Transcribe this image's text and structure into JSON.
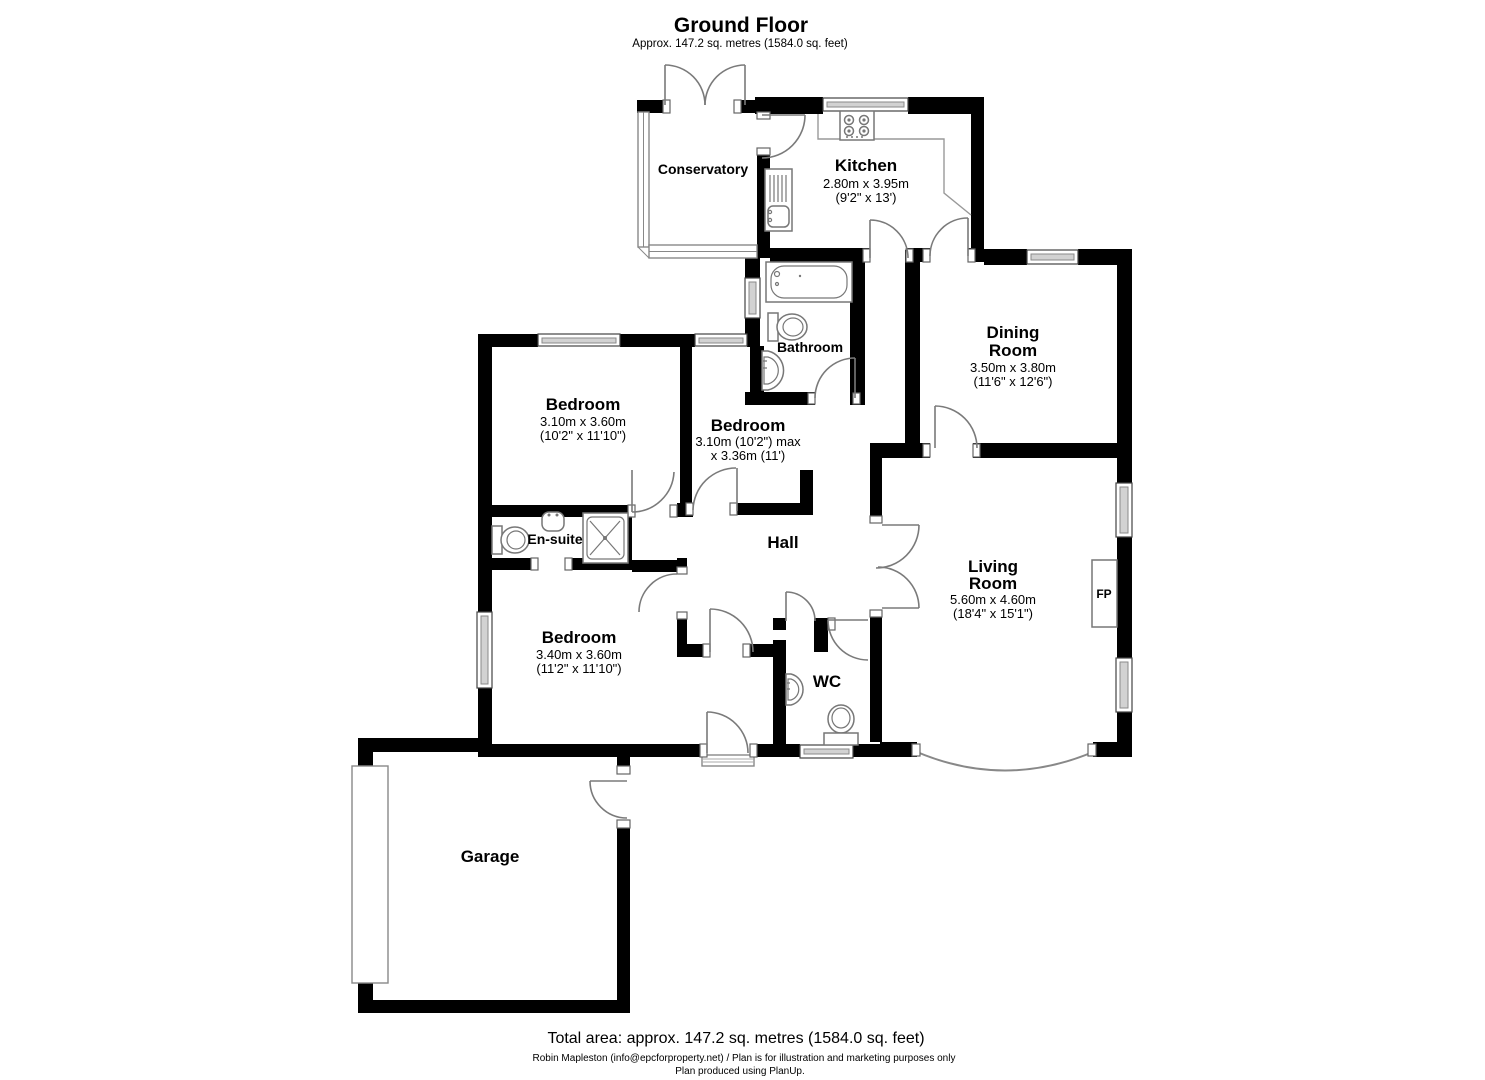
{
  "header": {
    "title": "Ground Floor",
    "subtitle": "Approx. 147.2 sq. metres (1584.0 sq. feet)"
  },
  "rooms": {
    "conservatory": {
      "name": "Conservatory"
    },
    "kitchen": {
      "name": "Kitchen",
      "size_metric": "2.80m x 3.95m",
      "size_imperial": "(9'2\" x 13')"
    },
    "bathroom": {
      "name": "Bathroom"
    },
    "dining_room": {
      "name_line1": "Dining",
      "name_line2": "Room",
      "size_metric": "3.50m x 3.80m",
      "size_imperial": "(11'6\" x 12'6\")"
    },
    "bedroom_rear": {
      "name": "Bedroom",
      "size_metric": "3.10m x 3.60m",
      "size_imperial": "(10'2\" x 11'10\")"
    },
    "bedroom_middle": {
      "name": "Bedroom",
      "size_line1": "3.10m (10'2\") max",
      "size_line2": "x 3.36m (11')"
    },
    "ensuite": {
      "name": "En-suite"
    },
    "bedroom_front": {
      "name": "Bedroom",
      "size_metric": "3.40m x 3.60m",
      "size_imperial": "(11'2\" x 11'10\")"
    },
    "hall": {
      "name": "Hall"
    },
    "wc": {
      "name": "WC"
    },
    "living_room": {
      "name_line1": "Living",
      "name_line2": "Room",
      "size_metric": "5.60m x 4.60m",
      "size_imperial": "(18'4\" x 15'1\")"
    },
    "garage": {
      "name": "Garage"
    },
    "fireplace": {
      "label": "FP"
    }
  },
  "footer": {
    "total_area": "Total area: approx. 147.2 sq. metres (1584.0 sq. feet)",
    "credit": "Robin Mapleston (info@epcforproperty.net) / Plan is for illustration and marketing purposes only",
    "produced": "Plan produced using PlanUp."
  }
}
